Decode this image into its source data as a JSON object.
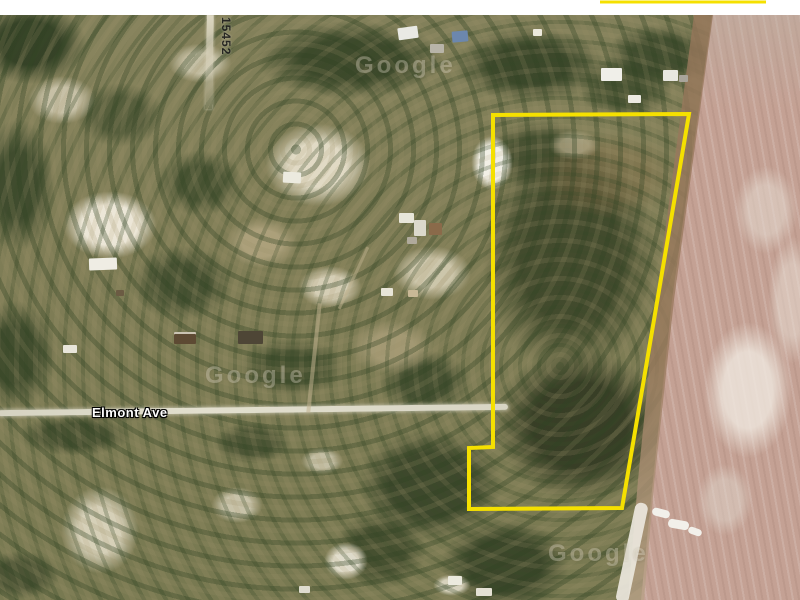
{
  "map": {
    "street_label": "Elmont Ave",
    "lot_number": "15452",
    "watermark_text": "Google",
    "outline_color": "#F5E000",
    "parcel_outline_points": "493,115 689,114 622,508 469,509 469,448 493,447",
    "top_partial_outline_points": "600,2 766,2"
  }
}
